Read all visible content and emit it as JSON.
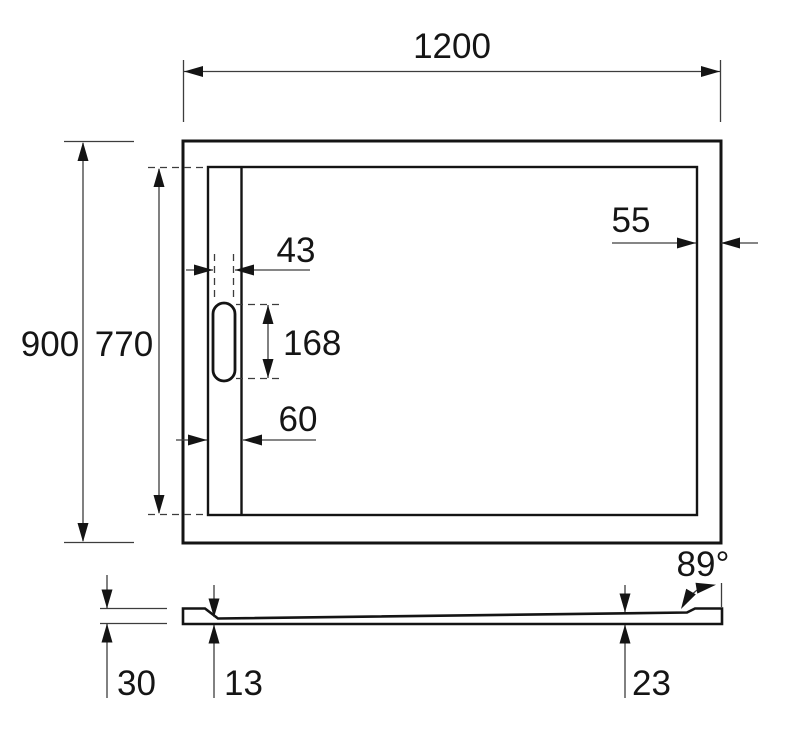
{
  "colors": {
    "object_line": "#141414",
    "dimension_line": "#3d3d3d",
    "background": "#ffffff"
  },
  "plan_view": {
    "overall_width": "1200",
    "overall_depth": "900",
    "inner_depth": "770",
    "drain_cover_width": "43",
    "drain_cover_length": "168",
    "channel_width": "60",
    "rim_width": "55"
  },
  "section_view": {
    "edge_height": "30",
    "min_thickness": "13",
    "end_thickness": "23",
    "side_angle": "89°"
  }
}
